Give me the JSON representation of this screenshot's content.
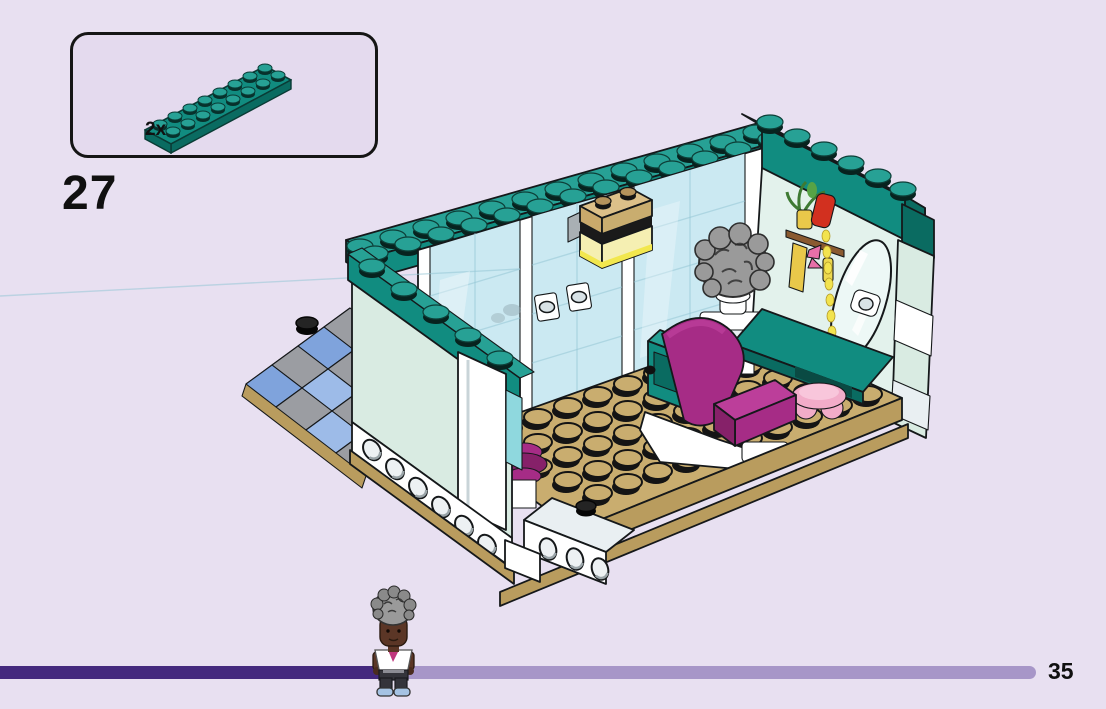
{
  "callout": {
    "quantity": "2x",
    "part_icon": "plate-2x8-dark-turquoise"
  },
  "step": {
    "number": "27"
  },
  "footer": {
    "page_number": "35",
    "progress_marker_icon": "mini-doll-figure"
  },
  "illustration": {
    "subject_icon": "lego-salon-room-model"
  },
  "colors": {
    "bg": "#E8E0F1",
    "callout_fill": "#E4DAEE",
    "teal": "#118C80",
    "teal_top": "#27A195",
    "teal_dark": "#0A6B61",
    "mint": "#D9EBE2",
    "mint_dark": "#C3DDD2",
    "mural": "#E3F2EC",
    "white": "#FFFFFF",
    "white_shade": "#E9EFF2",
    "glass": "#CBE9F2",
    "glass_line": "#96C6D6",
    "glass_hi": "#E9F8FB",
    "tan": "#C9AD6F",
    "tan_edge": "#B99C5E",
    "tan_dark": "#A88D52",
    "tan_light": "#DCC089",
    "magenta": "#A62C86",
    "magenta_dark": "#862169",
    "magenta_light": "#BC3E9A",
    "pink": "#F2ACC9",
    "red": "#D2301F",
    "yellow": "#E9C84A",
    "trans_yellow": "#F5EFB2",
    "yellow_bright": "#F2E74E",
    "tile_blue": "#7FA3DC",
    "tile_blue_light": "#9DBBE8",
    "tile_gray": "#9B9DA2",
    "bar_dark": "#44297E",
    "bar_light": "#A796C8",
    "skin": "#5B3626",
    "hair": "#9A9A9A",
    "pants": "#34343B",
    "shoes": "#A5C3E3"
  }
}
